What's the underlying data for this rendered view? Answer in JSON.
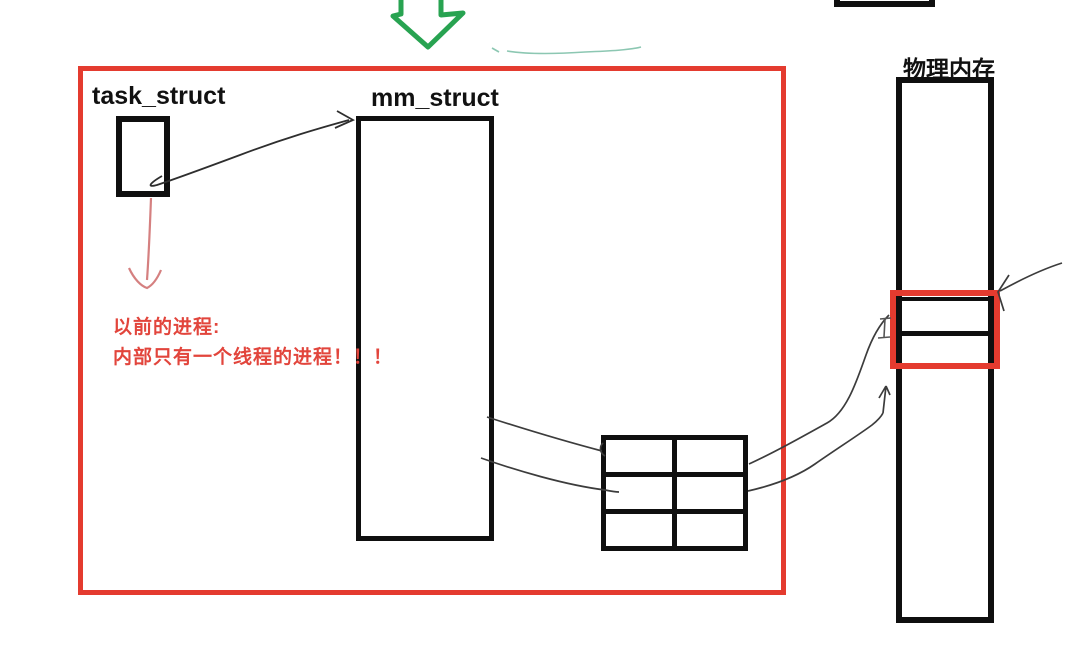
{
  "diagram": {
    "description": "hand-drawn sketch of process memory structures mapping to physical memory",
    "labels": {
      "task_struct": "task_struct",
      "mm_struct": "mm_struct",
      "physical_memory": "物理内存",
      "note_line1": "以前的进程:",
      "note_line2": "内部只有一个线程的进程！！！"
    },
    "shapes": {
      "green_down_arrow": "hollow green block arrow pointing down at top of screen",
      "red_frame": "large red rectangle enclosing task_struct, mm_struct, notes and page table grid",
      "task_struct_box": "small black rectangle under task_struct label",
      "mm_struct_box": "tall black rectangle under mm_struct label",
      "page_table_grid": "black 2-column by 3-row grid",
      "physical_memory_bar": "tall black rectangle under 物理内存 label",
      "red_highlight_box": "red rectangle highlighting two cells of the physical memory bar",
      "top_right_partial_box": "black rectangle cut off by the top edge of the screen"
    },
    "connectors": [
      "black squiggly arrow from task_struct box to mm_struct box",
      "salmon red arrow from task_struct box down to red note text",
      "two thin lines from mm_struct right edge to page table grid",
      "two thin lines from page table grid up to highlighted physical memory cells",
      "thin arrow from upper right pointing at top-right corner of the red highlight box",
      "faint teal underline squiggle below the green arrow"
    ],
    "colors": {
      "red": "#e43b2f",
      "red_text": "#e2453c",
      "green": "#28a351",
      "salmon": "#d58080",
      "ink": "#0f0f0f",
      "thin_line": "#3c3c3c",
      "teal": "#8cc7b2"
    }
  }
}
